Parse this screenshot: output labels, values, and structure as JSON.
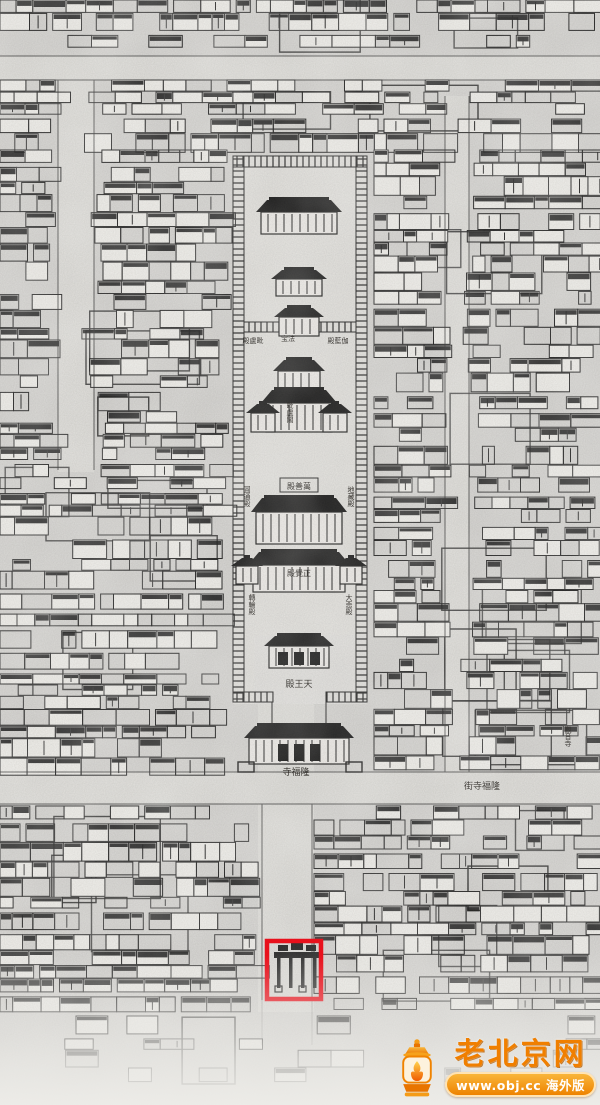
{
  "map_labels": {
    "rear_left": "殿盧毗",
    "rear_center": "宝法",
    "rear_right": "殿藍伽",
    "tower": "毗盧閣",
    "main_hall": "殿善萬",
    "hall_side_nw": "圓通殿",
    "hall_side_ne": "地藏殿",
    "second_hall": "殿覺正",
    "hall_side_sw": "轉輪殿",
    "hall_side_se": "大悲殿",
    "tianwang_hall": "殿王天",
    "temple_gate": "寺福隆",
    "street": "街寺福隆",
    "right_temple": "觀音寺"
  },
  "annotation": {
    "type": "highlight-box",
    "color": "#e8111c"
  },
  "watermark": {
    "title": "老北京网",
    "url_line": "www.obj.cc 海外版",
    "brand_color": "#f08300"
  },
  "palette": {
    "paper": "#d5d4d1",
    "ink": "#1f1f1f"
  }
}
